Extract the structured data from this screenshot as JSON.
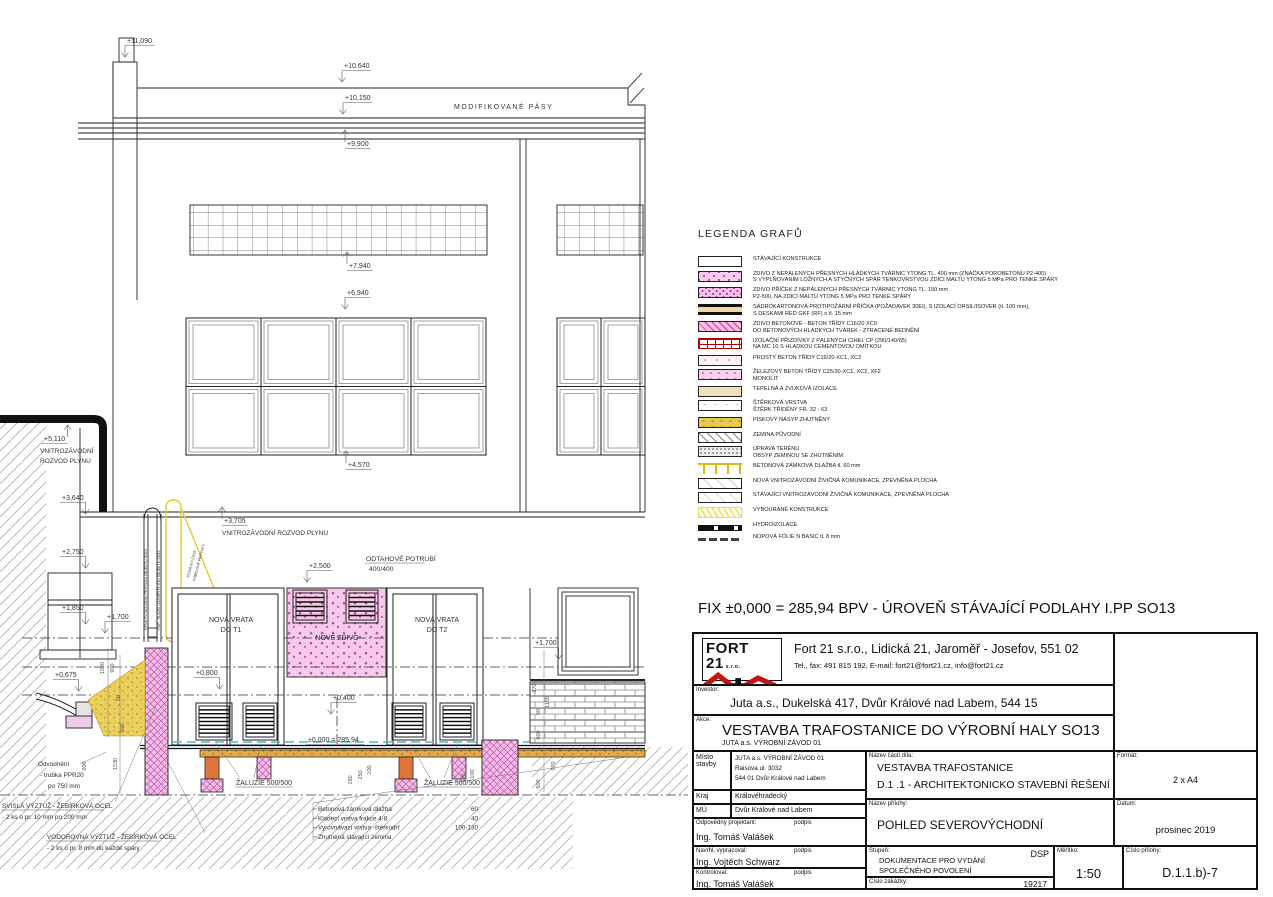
{
  "legend": {
    "title": "LEGENDA GRAFŮ",
    "items": [
      {
        "pattern": "plain",
        "lines": [
          "STÁVAJÍCÍ KONSTRUKCE"
        ]
      },
      {
        "pattern": "ytong",
        "lines": [
          "ZDIVO Z NEPÁLENÝCH PŘESNÝCH HLADKÝCH TVÁRNIC YTONG TL. 400 mm (ZNAČKA POROBETONU P2-400)",
          "S VYPLŇOVÁNÍM LOŽNÝCH A STYČNÝCH SPÁR TENKOVRSTVOU ZDÍCÍ MALTU YTONG 5 MPa PRO TENKÉ SPÁRY"
        ]
      },
      {
        "pattern": "ytong2",
        "lines": [
          "ZDIVO PŘÍČEK Z NEPÁLENÝCH PŘESNÝCH TVÁRNIC YTONG TL. 150 mm",
          "P2-500, NA ZDÍCÍ MALTU YTONG 5 MPa PRO TENKÉ SPÁRY"
        ]
      },
      {
        "pattern": "sadro",
        "lines": [
          "SÁDROKARTONOVÁ PROTIPOŽÁRNÍ PŘÍČKA (POŽADAVEK 30EI), S IZOLACÍ ORSIL/ISOVER (tl. 100 mm),",
          "S DESKAMI RED GKF (RF) o tl. 15 mm"
        ]
      },
      {
        "pattern": "pinkhatch",
        "lines": [
          "ZDIVO BETONOVÉ - BETON TŘÍDY C16/20 XC0",
          "DO BETONOVÝCH HLADKÝCH TVÁREK - ZTRACENÉ BEDNĚNÍ"
        ]
      },
      {
        "pattern": "brickred",
        "lines": [
          "IZOLAČNÍ PŘIZDÍVKY Z PÁLENÝCH CIHEL CP (290/140/65)",
          "NA MC 10 S HLADKOU CEMENTOVOU OMÍTKOU"
        ]
      },
      {
        "pattern": "beton1",
        "lines": [
          "PROSTÝ BETON TŘÍDY C16/20-XC1, XC2"
        ]
      },
      {
        "pattern": "beton2",
        "lines": [
          "ŽELEZOVÝ BETON TŘÍDY C25/30-XC1, XC2, XF2",
          "MONOLIT"
        ]
      },
      {
        "pattern": "tepelna",
        "lines": [
          "TEPELNÁ A ZVUKOVÁ IZOLACE"
        ]
      },
      {
        "pattern": "sterk",
        "lines": [
          "ŠTĚRKOVÁ VRSTVA",
          "ŠTĚRK TŘÍDĚNÝ FR. 32 - 63"
        ]
      },
      {
        "pattern": "pisek",
        "lines": [
          "PÍSKOVÝ NÁSYP ZHUTNĚNÝ"
        ]
      },
      {
        "pattern": "zemina",
        "lines": [
          "ZEMINA PŮVODNÍ"
        ]
      },
      {
        "pattern": "uprava",
        "lines": [
          "ÚPRAVA TERÉNU",
          "OBSYP ZEMINOU SE ZHUTNĚNÍM"
        ]
      },
      {
        "pattern": "dlazba",
        "lines": [
          "BETONOVÁ ZÁMKOVÁ DLAŽBA tl. 60 mm"
        ]
      },
      {
        "pattern": "komun1",
        "lines": [
          "NOVÁ VNITROZÁVODNÍ ŽIVIČNÁ KOMUNIKACE, ZPEVNĚNÁ PLOCHA"
        ]
      },
      {
        "pattern": "komun2",
        "lines": [
          "STÁVAJÍCÍ VNITROZÁVODNÍ ŽIVIČNÁ KOMUNIKACE, ZPEVNĚNÁ PLOCHA"
        ]
      },
      {
        "pattern": "vybourane",
        "lines": [
          "VYBOURANÉ KONSTRUKCE"
        ]
      },
      {
        "pattern": "hydro",
        "lines": [
          "HYDROIZOLACE"
        ]
      },
      {
        "pattern": "nopova",
        "lines": [
          "NOPOVÁ FÓLIE N BASIC tl. 8 mm"
        ]
      }
    ]
  },
  "fix_note": "FIX ±0,000 = 285,94 BPV - ÚROVEŇ STÁVAJÍCÍ PODLAHY I.PP SO13",
  "title_block": {
    "company": {
      "logo_text": "FORT 21",
      "logo_sub": "s.r.o.",
      "name_line": "Fort 21 s.r.o., Lidická 21, Jaroměř - Josefov, 551 02",
      "contact_line": "Tel., fax: 491 815 192,  E-mail: fort21@fort21.cz, info@fort21.cz"
    },
    "investor_label": "Investor:",
    "investor": "Juta a.s., Dukelská 417, Dvůr Králové nad Labem, 544 15",
    "akce_label": "Akce:",
    "akce": "VESTAVBA TRAFOSTANICE DO VÝROBNÍ HALY SO13",
    "akce_sub": "JUTA a.s. VÝROBNÍ ZÁVOD 01",
    "misto_label1": "Místo",
    "misto_label2": "stavby",
    "misto_line1": "JUTA a.s. VÝROBNÍ ZÁVOD 01",
    "misto_line2": "Raisova ul. 3032",
    "misto_line3": "544 01  Dvůr Králové nad Labem",
    "kraj_label": "Kraj",
    "kraj": "Královéhradecký",
    "mu_label": "MÚ",
    "mu": "Dvůr Králové nad Labem",
    "odp_label": "Odpovědný projektant:",
    "podpis": "podpis",
    "odp_name": "Ing. Tomáš Valášek",
    "navrhl_label": "Navrhl, vypracoval:",
    "navrhl_name": "Ing. Vojtěch Schwarz",
    "kontroloval_label": "Kontroloval:",
    "kontroloval_name": "Ing. Tomáš Valášek",
    "nazev_casti_label": "Název části díla:",
    "nazev_casti_1": "VESTAVBA TRAFOSTANICE",
    "nazev_casti_2": "D.1 .1 - ARCHITEKTONICKO STAVEBNÍ ŘEŠENÍ",
    "format_label": "Formát:",
    "format": "2 x A4",
    "nazev_prilohy_label": "Název přílohy:",
    "nazev_prilohy": "POHLED SEVEROVÝCHODNÍ",
    "datum_label": "Datum:",
    "datum": "prosinec 2019",
    "stupen_label": "Stupeň:",
    "stupen_badge": "DSP",
    "stupen_1": "DOKUMENTACE PRO VYDÁNÍ",
    "stupen_2": "SPOLEČNÉHO POVOLENÍ",
    "cislo_zakazky_label": "Číslo zakázky:",
    "cislo_zakazky": "19217",
    "meritko_label": "Měřítko:",
    "meritko": "1:50",
    "cislo_prilohy_label": "Číslo přílohy:",
    "cislo_prilohy": "D.1.1.b)-7"
  },
  "drawing": {
    "elevation_markers": [
      {
        "t": "+11,090",
        "x": 127,
        "y": 43,
        "dir": "dl"
      },
      {
        "t": "+10,640",
        "x": 344,
        "y": 68,
        "dir": "dl"
      },
      {
        "t": "+10,150",
        "x": 345,
        "y": 100,
        "dir": "dl"
      },
      {
        "t": "+9,900",
        "x": 347,
        "y": 146,
        "dir": "ul"
      },
      {
        "t": "+7,940",
        "x": 349,
        "y": 268,
        "dir": "ul"
      },
      {
        "t": "+6,940",
        "x": 347,
        "y": 295,
        "dir": "dl"
      },
      {
        "t": "+4,570",
        "x": 348,
        "y": 467,
        "dir": "ul"
      },
      {
        "t": "+5,110",
        "x": 44,
        "y": 441,
        "dir": "ur"
      },
      {
        "t": "+3,640",
        "x": 62,
        "y": 500,
        "dir": "dr"
      },
      {
        "t": "+3,705",
        "x": 224,
        "y": 523,
        "dir": "ul"
      },
      {
        "t": "+2,750",
        "x": 62,
        "y": 554,
        "dir": "dr"
      },
      {
        "t": "+1,850",
        "x": 62,
        "y": 610,
        "dir": "dr"
      },
      {
        "t": "+1,700",
        "x": 107,
        "y": 619,
        "dir": "dl"
      },
      {
        "t": "+0,675",
        "x": 55,
        "y": 677,
        "dir": "dr"
      },
      {
        "t": "+2,500",
        "x": 309,
        "y": 568,
        "dir": "dl"
      },
      {
        "t": "+0,800",
        "x": 196,
        "y": 675,
        "dir": "dr"
      },
      {
        "t": "+0,400",
        "x": 333,
        "y": 700,
        "dir": "dl"
      },
      {
        "t": "+1,700",
        "x": 535,
        "y": 645,
        "dir": "dr"
      },
      {
        "t": "±0,000 = 285,94",
        "x": 308,
        "y": 742,
        "dir": "none"
      }
    ],
    "labels": [
      {
        "t": "MODIFIKOVANÉ PÁSY",
        "x": 454,
        "y": 109,
        "s": 7,
        "ls": 1.5
      },
      {
        "t": "VNITROZÁVODNÍ",
        "x": 40,
        "y": 453,
        "s": 6.5
      },
      {
        "t": "ROZVOD PLYNU",
        "x": 40,
        "y": 463,
        "s": 6.5
      },
      {
        "t": "VNITROZÁVODNÍ ROZVOD PLYNU",
        "x": 222,
        "y": 535,
        "s": 6.5
      },
      {
        "t": "ODTAHOVÉ POTRUBÍ",
        "x": 366,
        "y": 561,
        "s": 6.8,
        "u": 1
      },
      {
        "t": "400/400",
        "x": 369,
        "y": 571,
        "s": 6.8
      },
      {
        "t": "NOVÁ VRATA",
        "x": 231,
        "y": 622,
        "s": 7,
        "a": "middle"
      },
      {
        "t": "DO T1",
        "x": 231,
        "y": 632,
        "s": 7,
        "a": "middle"
      },
      {
        "t": "NOVÁ VRATA",
        "x": 437,
        "y": 622,
        "s": 7,
        "a": "middle"
      },
      {
        "t": "DO T2",
        "x": 437,
        "y": 632,
        "s": 7,
        "a": "middle"
      },
      {
        "t": "NOVÉ ZDIVO",
        "x": 337,
        "y": 640,
        "s": 7,
        "a": "middle"
      },
      {
        "t": "ŽALUZIE 500/500",
        "x": 236,
        "y": 785,
        "s": 7,
        "u": 1
      },
      {
        "t": "ŽALUZIE 500/500",
        "x": 424,
        "y": 785,
        "s": 7,
        "u": 1
      },
      {
        "t": "Odvodnění",
        "x": 38,
        "y": 766,
        "s": 6.4
      },
      {
        "t": "-  trubka PPR20",
        "x": 40,
        "y": 777,
        "s": 6.4
      },
      {
        "t": "po 750 mm",
        "x": 48,
        "y": 788,
        "s": 6.4
      },
      {
        "t": "SVISLÁ VÝZTUŽ - ŽEBÍRKOVÁ OCEL",
        "x": 2,
        "y": 808,
        "s": 6.4,
        "u": 1
      },
      {
        "t": "- 2 ks o pr. 10 mm po 200 mm",
        "x": 2,
        "y": 819,
        "s": 6.4
      },
      {
        "t": "VODOROVNÁ VÝZTUŽ - ŽEBÍRKOVÁ OCEL",
        "x": 47,
        "y": 839,
        "s": 6.4,
        "u": 1
      },
      {
        "t": "- 2 ks o pr. 8 mm do každé spáry",
        "x": 47,
        "y": 850,
        "s": 6.4
      },
      {
        "t": "NOVÁ PLYNOVODNÍ PŘÍPOJKA OBJEKTU SO13",
        "x": 147,
        "y": 630,
        "s": 3.6,
        "rot": -90
      },
      {
        "t": "HUP - HLAVNÍ UZÁVĚR PLYNU OBJEKTU SO13",
        "x": 160,
        "y": 630,
        "s": 3.6,
        "rot": -90
      },
      {
        "t": "STÁVAJÍCÍ ČÁST",
        "x": 189,
        "y": 578,
        "s": 3.6,
        "rot": -75
      },
      {
        "t": "KABELOVÉ PŘÍPOJKY",
        "x": 195,
        "y": 581,
        "s": 3.6,
        "rot": -75
      }
    ],
    "dimensions": [
      {
        "t": "1020",
        "x": 104,
        "y": 668
      },
      {
        "t": "900",
        "x": 114,
        "y": 668
      },
      {
        "t": "50",
        "x": 120,
        "y": 698
      },
      {
        "t": "600",
        "x": 124,
        "y": 728
      },
      {
        "t": "1530",
        "x": 117,
        "y": 764
      },
      {
        "t": "600",
        "x": 86,
        "y": 766
      },
      {
        "t": "160",
        "x": 352,
        "y": 780
      },
      {
        "t": "250",
        "x": 362,
        "y": 775
      },
      {
        "t": "100",
        "x": 371,
        "y": 770
      },
      {
        "t": "100",
        "x": 465,
        "y": 778
      },
      {
        "t": "100",
        "x": 474,
        "y": 774
      },
      {
        "t": "670",
        "x": 536,
        "y": 688
      },
      {
        "t": "1150",
        "x": 549,
        "y": 702
      },
      {
        "t": "50",
        "x": 540,
        "y": 712
      },
      {
        "t": "600",
        "x": 540,
        "y": 735
      },
      {
        "t": "970",
        "x": 555,
        "y": 766
      },
      {
        "t": "600",
        "x": 540,
        "y": 784
      }
    ],
    "layer_notes": [
      {
        "name": "Betonová zámková dlažba",
        "value": "60"
      },
      {
        "name": "Kladecí vrstva frakce 4-8",
        "value": "40"
      },
      {
        "name": "Vyrovnávací vrstva -štěrkodrť",
        "value": "100-130"
      },
      {
        "name": "Zhutněná stávající zemina",
        "value": ""
      }
    ]
  }
}
